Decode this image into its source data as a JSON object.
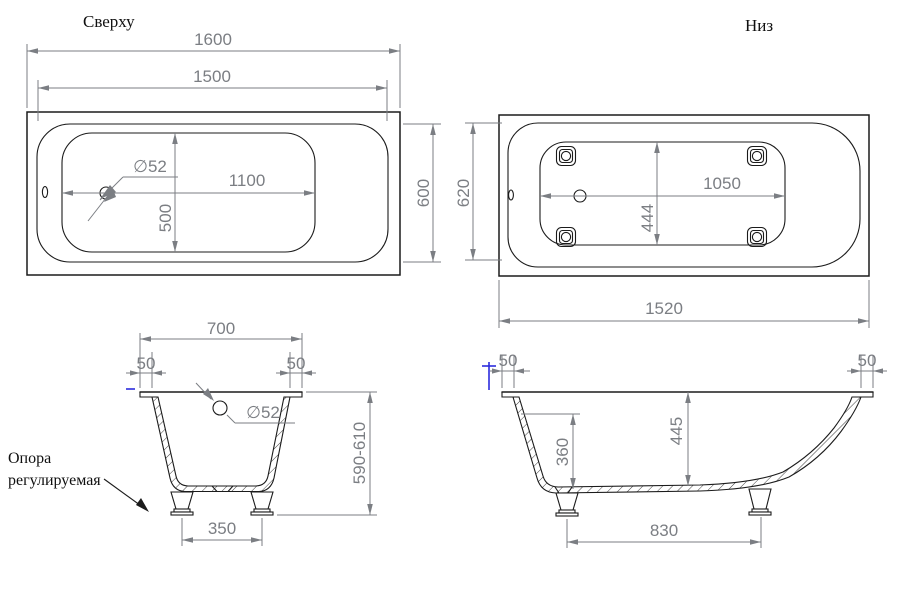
{
  "titles": {
    "top_view": "Сверху",
    "bottom_view": "Низ"
  },
  "annotations": {
    "support_line1": "Опора",
    "support_line2": "регулируемая"
  },
  "top_view": {
    "overall_length": "1600",
    "rim_length": "1500",
    "drain_diameter": "∅52",
    "drain_offset": "1100",
    "floor_width": "500",
    "rim_width": "600"
  },
  "bottom_view": {
    "overall_width": "620",
    "feet_span_length": "1050",
    "feet_span_width": "444",
    "overall_length": "1520"
  },
  "front_section": {
    "top_width": "700",
    "rim_lip_left": "50",
    "rim_lip_right": "50",
    "drain_diameter": "∅52",
    "height_range": "590-610",
    "feet_span": "350"
  },
  "side_section": {
    "rim_lip_left": "50",
    "rim_lip_right": "50",
    "wall_depth": "360",
    "center_depth": "445",
    "feet_span": "830"
  },
  "colors": {
    "geometry": "#1b1b1b",
    "dimension": "#7b7e83",
    "accent_blue": "#2b2bdd",
    "background": "#ffffff"
  }
}
